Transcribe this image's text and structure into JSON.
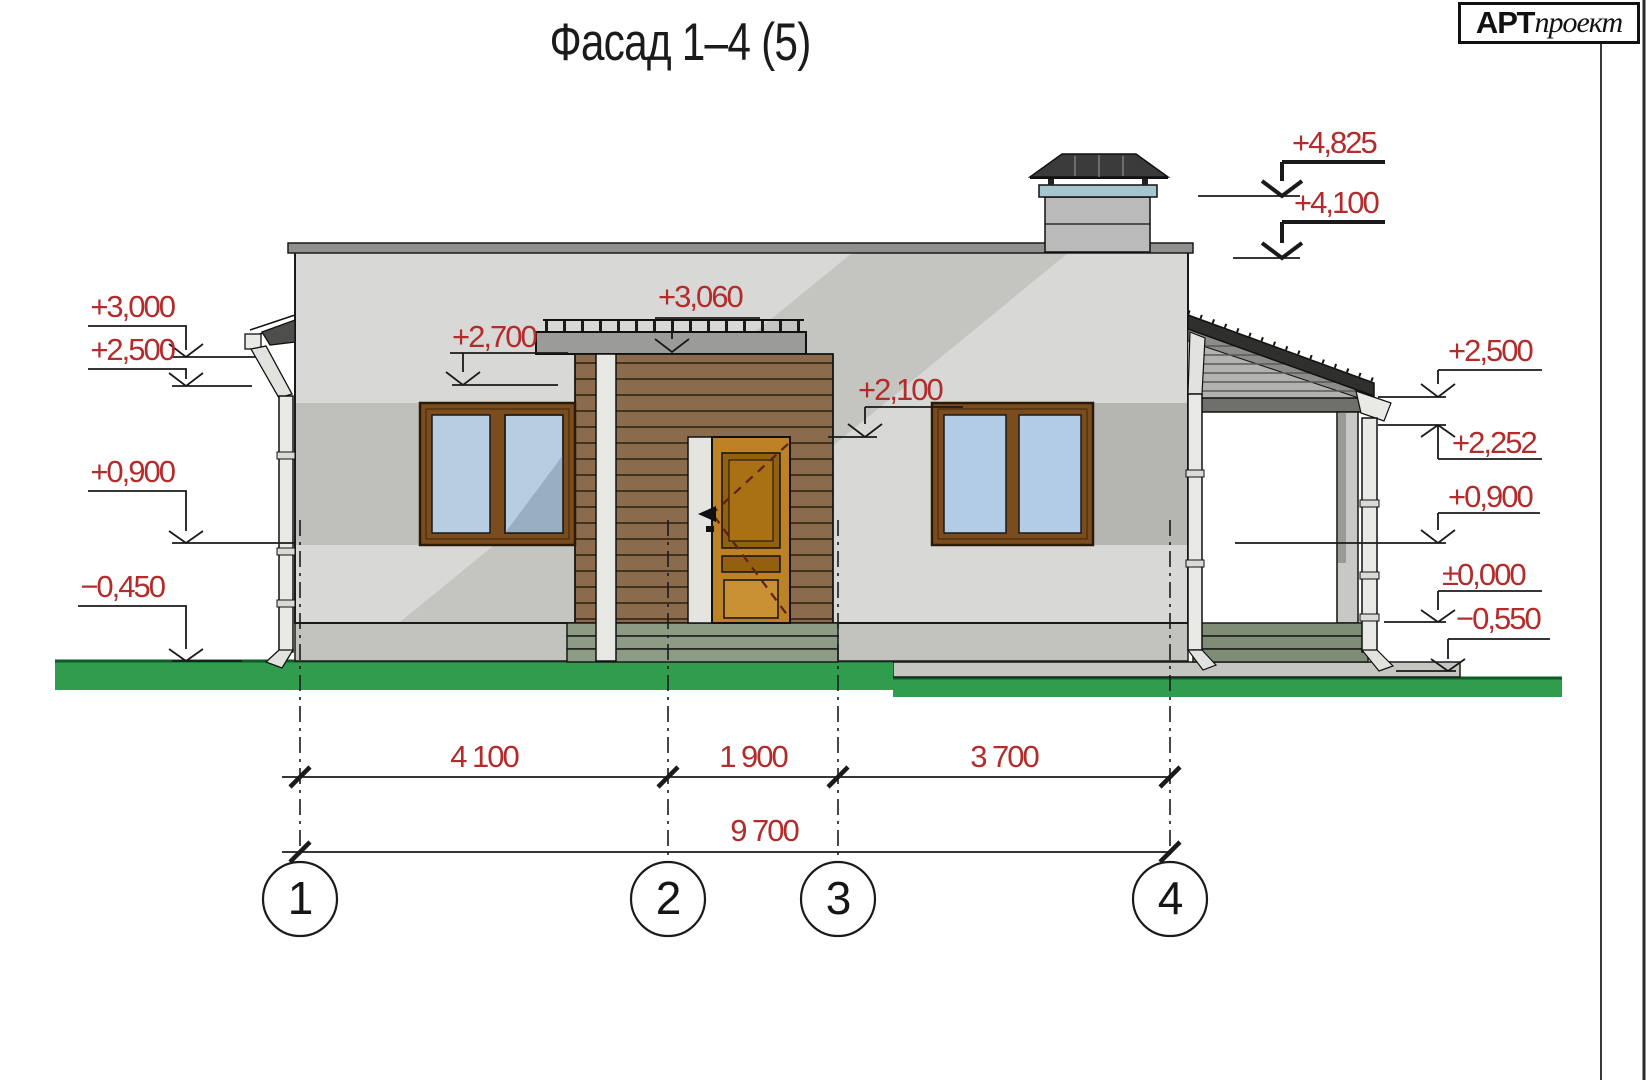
{
  "title": "Фасад 1–4 (5)",
  "logo": {
    "brand_bold": "АРТ",
    "brand_italic": "проект"
  },
  "drawing": {
    "type": "architectural-facade-elevation",
    "elevation_marks": {
      "left": [
        "+3,000",
        "+2,500",
        "+0,900",
        "−0,450"
      ],
      "center": [
        "+2,700",
        "+3,060",
        "+2,100"
      ],
      "right_top": [
        "+4,825",
        "+4,100"
      ],
      "right": [
        "+2,500",
        "+2,252",
        "+0,900",
        "±0,000",
        "−0,550"
      ]
    },
    "dimensions": {
      "spans": [
        "4 100",
        "1 900",
        "3 700"
      ],
      "total": "9 700"
    },
    "axes": [
      "1",
      "2",
      "3",
      "4"
    ],
    "colors": {
      "dimension_red": "#b32b2b",
      "grass_green": "#2f9d4d",
      "wood_brown": "#8b6b4d",
      "wall_gray": "#d8d8d6",
      "glass_blue": "#b6cde2"
    }
  }
}
